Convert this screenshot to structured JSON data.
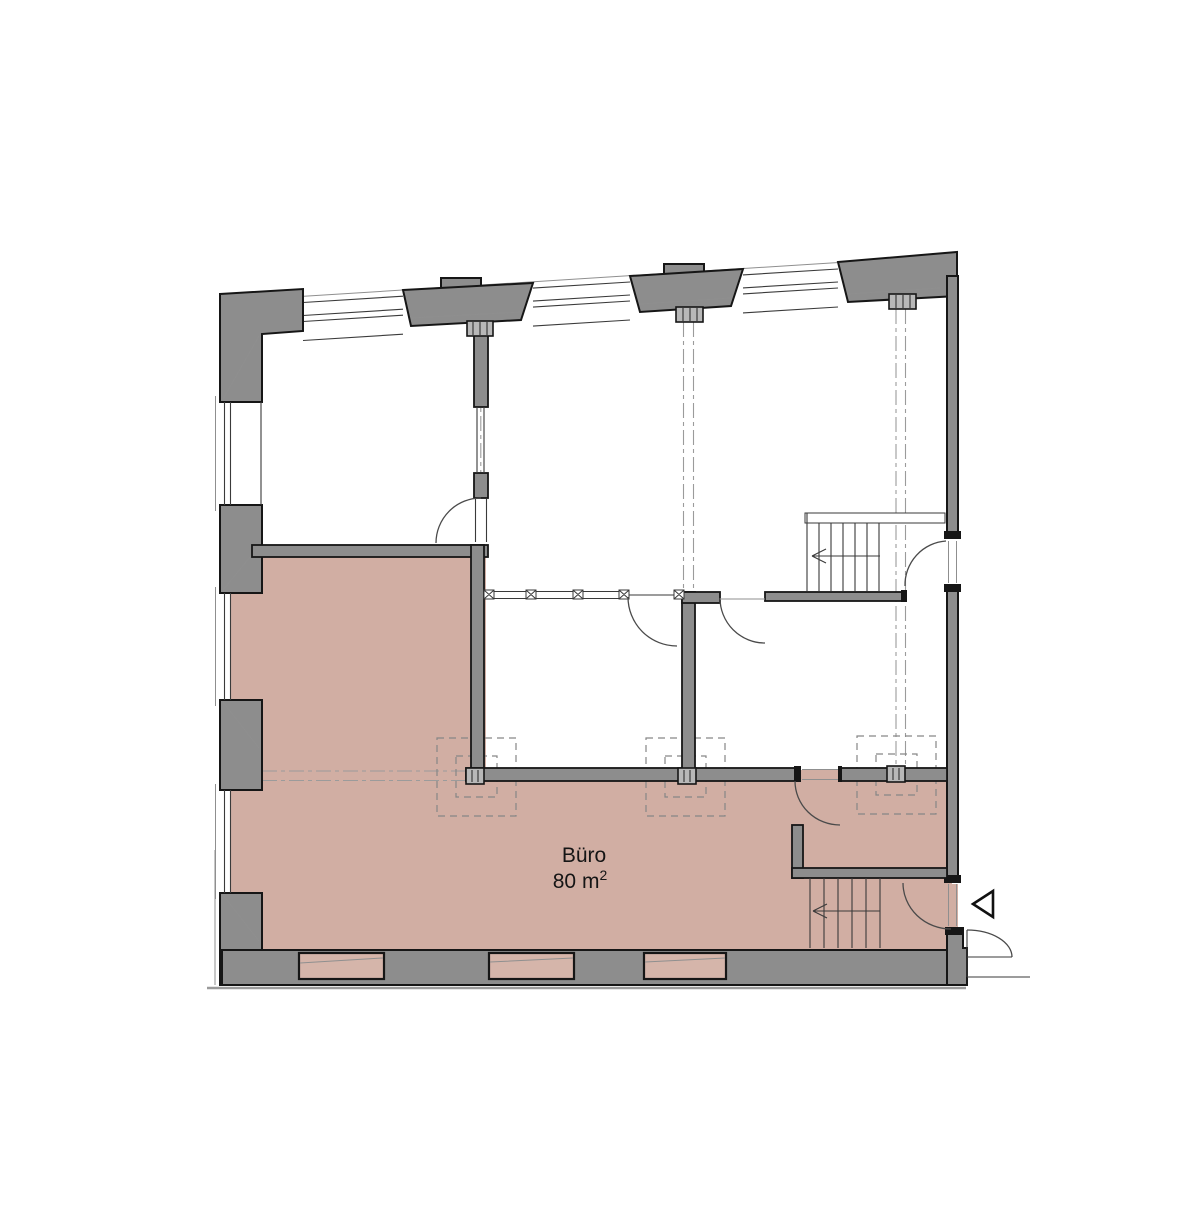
{
  "floor_plan": {
    "room": {
      "label": "Büro",
      "area_base": "80 m",
      "area_sup": "2"
    }
  },
  "icons": {
    "entrance_marker": "triangle-left-icon",
    "stair_direction_upper": "arrow-left-icon",
    "stair_direction_lower": "arrow-left-icon"
  },
  "colors": {
    "bg": "#ffffff",
    "wall-fill": "#8d8d8d",
    "wall-stroke": "#161616",
    "floor-pink": "#d1aea3",
    "niche-pink": "#d5b5aa",
    "line-thin": "#3a3a3a",
    "line-mid": "#8f8f8f",
    "arc-color": "#4a4a4a",
    "centerline": "#9b9b9b",
    "dashed-box": "#868686",
    "column-fill": "#b8b8b8",
    "ground-line": "#9a9a9a"
  }
}
